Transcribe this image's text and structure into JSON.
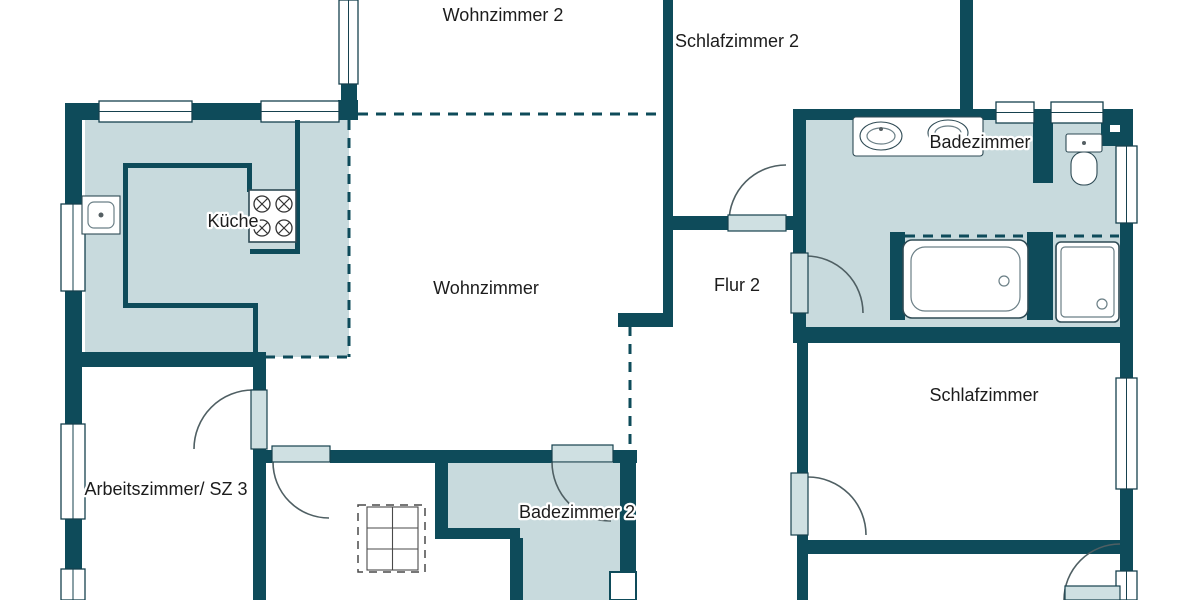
{
  "title": "Grundriss (floor plan)",
  "colors": {
    "wall": "#0e4b5a",
    "room_fill": "#c8dadd",
    "door_leaf": "#cfe0e2",
    "window_border": "#16414e",
    "arc": "#4f5f63",
    "text": "#1c1c1c",
    "background": "#ffffff"
  },
  "rooms": [
    {
      "id": "wohnzimmer-2",
      "label": "Wohnzimmer 2"
    },
    {
      "id": "schlafzimmer-2",
      "label": "Schlafzimmer 2"
    },
    {
      "id": "badezimmer",
      "label": "Badezimmer"
    },
    {
      "id": "kueche",
      "label": "Küche"
    },
    {
      "id": "wohnzimmer",
      "label": "Wohnzimmer"
    },
    {
      "id": "flur-2",
      "label": "Flur 2"
    },
    {
      "id": "schlafzimmer",
      "label": "Schlafzimmer"
    },
    {
      "id": "arbeitszimmer-sz3",
      "label": "Arbeitszimmer/ SZ 3"
    },
    {
      "id": "badezimmer-2",
      "label": "Badezimmer 2"
    }
  ],
  "fixtures": [
    "kitchen-sink",
    "stove",
    "vanity-double-sink",
    "toilet",
    "bathtub",
    "shower",
    "dining-table-dashed"
  ]
}
